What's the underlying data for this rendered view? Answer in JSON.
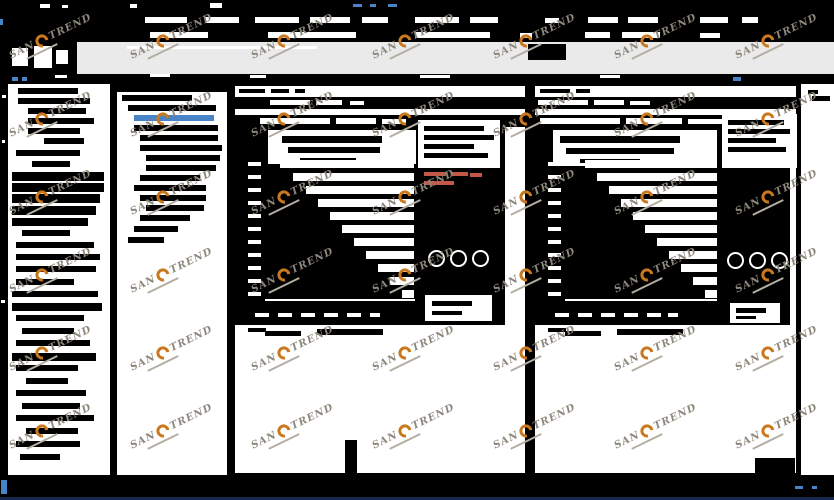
{
  "app": {
    "watermark": {
      "part1": "SAN",
      "part2": "TREND"
    },
    "colors": {
      "w": "#ffffff",
      "k": "#000000",
      "b": "#4a84c8",
      "r": "#c45747",
      "toolbar_gray": "#eaeaea",
      "watermark_orange": "#c9781e",
      "watermark_gray": "#8e887c",
      "status_blue": "#4a84c8",
      "bottom_line": "#16294d"
    }
  },
  "titlebar": {
    "fragments": [
      [
        40,
        4,
        10,
        4,
        "w"
      ],
      [
        62,
        5,
        6,
        3,
        "w"
      ],
      [
        130,
        4,
        7,
        4,
        "w"
      ],
      [
        210,
        3,
        12,
        5,
        "w"
      ],
      [
        353,
        4,
        9,
        3,
        "b"
      ],
      [
        370,
        4,
        6,
        3,
        "b"
      ],
      [
        388,
        4,
        9,
        3,
        "b"
      ]
    ]
  },
  "menubar": {
    "items": [
      [
        145,
        17,
        42,
        6
      ],
      [
        205,
        17,
        34,
        6
      ],
      [
        255,
        17,
        44,
        6
      ],
      [
        310,
        17,
        40,
        6
      ],
      [
        362,
        17,
        26,
        6
      ],
      [
        415,
        17,
        44,
        6
      ],
      [
        470,
        17,
        28,
        6
      ],
      [
        545,
        18,
        14,
        5
      ],
      [
        588,
        17,
        30,
        6
      ],
      [
        628,
        17,
        30,
        6
      ],
      [
        700,
        17,
        28,
        6
      ],
      [
        742,
        17,
        16,
        6
      ]
    ],
    "extra": [
      [
        0,
        19,
        3,
        6,
        "b"
      ]
    ]
  },
  "toolbarrow": {
    "fragments": [
      [
        150,
        32,
        58,
        6,
        "w"
      ],
      [
        268,
        32,
        88,
        6,
        "w"
      ],
      [
        415,
        32,
        75,
        6,
        "w"
      ],
      [
        520,
        33,
        12,
        5,
        "w"
      ],
      [
        585,
        32,
        25,
        6,
        "w"
      ],
      [
        622,
        32,
        38,
        6,
        "w"
      ],
      [
        700,
        33,
        20,
        5,
        "w"
      ]
    ]
  },
  "toolbar": {
    "icons": [
      [
        12,
        48,
        16,
        18
      ],
      [
        34,
        46,
        18,
        22
      ],
      [
        56,
        50,
        12,
        14
      ]
    ],
    "gray_fragments": [
      [
        528,
        44,
        38,
        16,
        "k"
      ],
      [
        127,
        46,
        190,
        3,
        "w"
      ]
    ]
  },
  "tabband": {
    "fragments": [
      [
        12,
        77,
        6,
        4,
        "b"
      ],
      [
        22,
        77,
        5,
        4,
        "b"
      ],
      [
        733,
        77,
        8,
        4,
        "b"
      ],
      [
        55,
        75,
        12,
        3,
        "w"
      ],
      [
        150,
        74,
        20,
        3,
        "w"
      ],
      [
        250,
        75,
        16,
        3,
        "w"
      ],
      [
        420,
        75,
        30,
        3,
        "w"
      ],
      [
        600,
        75,
        20,
        3,
        "w"
      ]
    ]
  },
  "sidebar": {
    "rect": [
      8,
      84,
      102,
      391
    ],
    "rows": [
      [
        18,
        88,
        60,
        6
      ],
      [
        18,
        98,
        72,
        6
      ],
      [
        28,
        108,
        58,
        6
      ],
      [
        28,
        118,
        66,
        6
      ],
      [
        28,
        128,
        52,
        6
      ],
      [
        44,
        138,
        40,
        6
      ],
      [
        16,
        150,
        64,
        6
      ],
      [
        32,
        161,
        38,
        6
      ],
      [
        12,
        172,
        92,
        9
      ],
      [
        12,
        183,
        92,
        9
      ],
      [
        12,
        194,
        88,
        9
      ],
      [
        12,
        206,
        84,
        9
      ],
      [
        12,
        218,
        76,
        8
      ],
      [
        22,
        230,
        48,
        6
      ],
      [
        16,
        242,
        78,
        6
      ],
      [
        16,
        254,
        84,
        6
      ],
      [
        16,
        266,
        80,
        6
      ],
      [
        16,
        279,
        58,
        6
      ],
      [
        12,
        291,
        86,
        6
      ],
      [
        12,
        303,
        90,
        8
      ],
      [
        16,
        315,
        68,
        6
      ],
      [
        22,
        328,
        52,
        6
      ],
      [
        16,
        340,
        74,
        6
      ],
      [
        12,
        353,
        84,
        8
      ],
      [
        16,
        365,
        62,
        6
      ],
      [
        26,
        378,
        42,
        6
      ],
      [
        16,
        390,
        70,
        6
      ],
      [
        22,
        403,
        58,
        6
      ],
      [
        16,
        415,
        78,
        6
      ],
      [
        26,
        428,
        52,
        6
      ],
      [
        16,
        441,
        64,
        6
      ],
      [
        20,
        454,
        40,
        6
      ]
    ],
    "edge_specks": [
      [
        2,
        95,
        4,
        3,
        "w"
      ],
      [
        2,
        140,
        3,
        3,
        "w"
      ],
      [
        1,
        300,
        4,
        3,
        "w"
      ]
    ]
  },
  "tree": {
    "rect": [
      117,
      84,
      110,
      391
    ],
    "header": [
      117,
      84,
      110,
      8
    ],
    "rows": [
      [
        122,
        95,
        70,
        false
      ],
      [
        128,
        105,
        88,
        false
      ],
      [
        134,
        115,
        80,
        true
      ],
      [
        134,
        125,
        84,
        false
      ],
      [
        140,
        135,
        78,
        false
      ],
      [
        140,
        145,
        82,
        false
      ],
      [
        146,
        155,
        74,
        false
      ],
      [
        146,
        165,
        70,
        false
      ],
      [
        140,
        175,
        60,
        false
      ],
      [
        134,
        185,
        72,
        false
      ],
      [
        140,
        195,
        66,
        false
      ],
      [
        146,
        205,
        58,
        false
      ],
      [
        140,
        215,
        50,
        false
      ],
      [
        134,
        226,
        44,
        false
      ],
      [
        128,
        237,
        36,
        false
      ]
    ]
  },
  "charts": [
    {
      "win": [
        233,
        84,
        294,
        391
      ],
      "topstrip_fragments": [
        [
          239,
          89,
          26,
          4
        ],
        [
          271,
          89,
          18,
          4
        ],
        [
          295,
          89,
          10,
          4
        ]
      ],
      "blackrow": [
        235,
        97,
        290,
        12
      ],
      "blackrow_fragments": [
        [
          270,
          100,
          40,
          5
        ],
        [
          316,
          100,
          26,
          5
        ],
        [
          350,
          101,
          14,
          4
        ]
      ],
      "caption": [
        235,
        115,
        290,
        12
      ],
      "caption_fragments": [
        [
          260,
          118,
          70,
          6
        ],
        [
          336,
          118,
          40,
          6
        ],
        [
          382,
          119,
          24,
          5
        ]
      ],
      "body": [
        235,
        127,
        270,
        198
      ],
      "title_box": [
        268,
        130,
        148,
        34
      ],
      "title_lines": [
        [
          282,
          136,
          100,
          7
        ],
        [
          288,
          147,
          92,
          6
        ],
        [
          300,
          158,
          56,
          4
        ]
      ],
      "legend_box": [
        418,
        120,
        82,
        48
      ],
      "legend_lines": [
        [
          424,
          126,
          60,
          5
        ],
        [
          424,
          135,
          70,
          5
        ],
        [
          424,
          144,
          50,
          5
        ],
        [
          424,
          153,
          64,
          5
        ]
      ],
      "red_marks": [
        [
          424,
          172,
          22,
          4
        ],
        [
          452,
          172,
          16,
          4
        ],
        [
          424,
          181,
          30,
          4
        ],
        [
          470,
          173,
          12,
          4
        ]
      ],
      "gap_right": 414,
      "gap_h": 8,
      "gaps": [
        [
          160,
          280
        ],
        [
          173,
          293
        ],
        [
          186,
          306
        ],
        [
          199,
          318
        ],
        [
          212,
          330
        ],
        [
          225,
          342
        ],
        [
          238,
          354
        ],
        [
          251,
          366
        ],
        [
          264,
          378
        ],
        [
          277,
          390
        ],
        [
          290,
          402
        ]
      ],
      "ylabel_x": 248,
      "axis": [
        265,
        299,
        150,
        2
      ],
      "ticks": [
        [
          255,
          313,
          14,
          4
        ],
        [
          278,
          313,
          14,
          4
        ],
        [
          301,
          313,
          14,
          4
        ],
        [
          324,
          313,
          14,
          4
        ],
        [
          347,
          313,
          14,
          4
        ],
        [
          370,
          313,
          10,
          4
        ]
      ],
      "rings": [
        [
          428,
          250
        ],
        [
          450,
          250
        ],
        [
          472,
          250
        ]
      ],
      "white_box2": [
        425,
        295,
        67,
        26
      ],
      "white_box2_lines": [
        [
          432,
          301,
          40,
          5
        ],
        [
          432,
          311,
          30,
          4
        ]
      ],
      "footnote": [
        [
          248,
          328,
          18,
          4
        ],
        [
          265,
          331,
          36,
          5
        ],
        [
          317,
          329,
          66,
          6
        ]
      ],
      "extra_black": [
        [
          345,
          440,
          12,
          34
        ]
      ]
    },
    {
      "win": [
        533,
        84,
        265,
        391
      ],
      "topstrip_fragments": [
        [
          540,
          89,
          30,
          4
        ],
        [
          576,
          89,
          14,
          4
        ]
      ],
      "blackrow": [
        535,
        97,
        261,
        12
      ],
      "blackrow_fragments": [
        [
          538,
          100,
          50,
          5
        ],
        [
          594,
          100,
          30,
          5
        ],
        [
          630,
          101,
          20,
          4
        ]
      ],
      "caption": [
        535,
        115,
        261,
        12
      ],
      "caption_fragments": [
        [
          540,
          118,
          80,
          6
        ],
        [
          626,
          118,
          56,
          6
        ],
        [
          688,
          119,
          36,
          5
        ],
        [
          730,
          119,
          20,
          5
        ]
      ],
      "body": [
        535,
        127,
        255,
        198
      ],
      "title_box": [
        553,
        130,
        164,
        36
      ],
      "title_lines": [
        [
          560,
          136,
          120,
          7
        ],
        [
          566,
          148,
          108,
          6
        ],
        [
          580,
          159,
          60,
          4
        ]
      ],
      "legend_box": [
        722,
        114,
        75,
        54
      ],
      "legend_lines": [
        [
          728,
          120,
          56,
          5
        ],
        [
          728,
          129,
          62,
          5
        ],
        [
          728,
          138,
          48,
          5
        ],
        [
          728,
          147,
          58,
          5
        ]
      ],
      "red_marks": [],
      "gap_right": 717,
      "gap_h": 8,
      "gaps": [
        [
          160,
          585
        ],
        [
          173,
          597
        ],
        [
          186,
          609
        ],
        [
          199,
          621
        ],
        [
          212,
          633
        ],
        [
          225,
          645
        ],
        [
          238,
          657
        ],
        [
          251,
          669
        ],
        [
          264,
          681
        ],
        [
          277,
          693
        ],
        [
          290,
          705
        ]
      ],
      "ylabel_x": 548,
      "axis": [
        565,
        299,
        152,
        2
      ],
      "ticks": [
        [
          555,
          313,
          14,
          4
        ],
        [
          578,
          313,
          14,
          4
        ],
        [
          601,
          313,
          14,
          4
        ],
        [
          624,
          313,
          14,
          4
        ],
        [
          647,
          313,
          14,
          4
        ],
        [
          668,
          313,
          10,
          4
        ]
      ],
      "rings": [
        [
          727,
          252
        ],
        [
          749,
          252
        ],
        [
          771,
          252
        ]
      ],
      "white_box2": [
        730,
        303,
        50,
        20
      ],
      "white_box2_lines": [
        [
          736,
          308,
          30,
          5
        ],
        [
          736,
          316,
          20,
          3
        ]
      ],
      "footnote": [
        [
          548,
          328,
          18,
          4
        ],
        [
          565,
          331,
          36,
          5
        ],
        [
          617,
          329,
          66,
          6
        ]
      ],
      "extra_black": [
        [
          755,
          458,
          40,
          16
        ]
      ]
    }
  ],
  "scrollstrip": {
    "rect": [
      801,
      84,
      33,
      391
    ],
    "fragments": [
      [
        808,
        90,
        10,
        4,
        "k"
      ],
      [
        812,
        96,
        18,
        5,
        "k"
      ]
    ]
  },
  "statusbar": {
    "fragments": [
      [
        1,
        480,
        6,
        14,
        "b"
      ],
      [
        795,
        486,
        8,
        3,
        "b"
      ],
      [
        812,
        486,
        5,
        3,
        "b"
      ]
    ]
  },
  "watermark_grid": {
    "cols": [
      10,
      131,
      252,
      373,
      494,
      615,
      736
    ],
    "rows": [
      50,
      128,
      206,
      284,
      362,
      440
    ]
  }
}
